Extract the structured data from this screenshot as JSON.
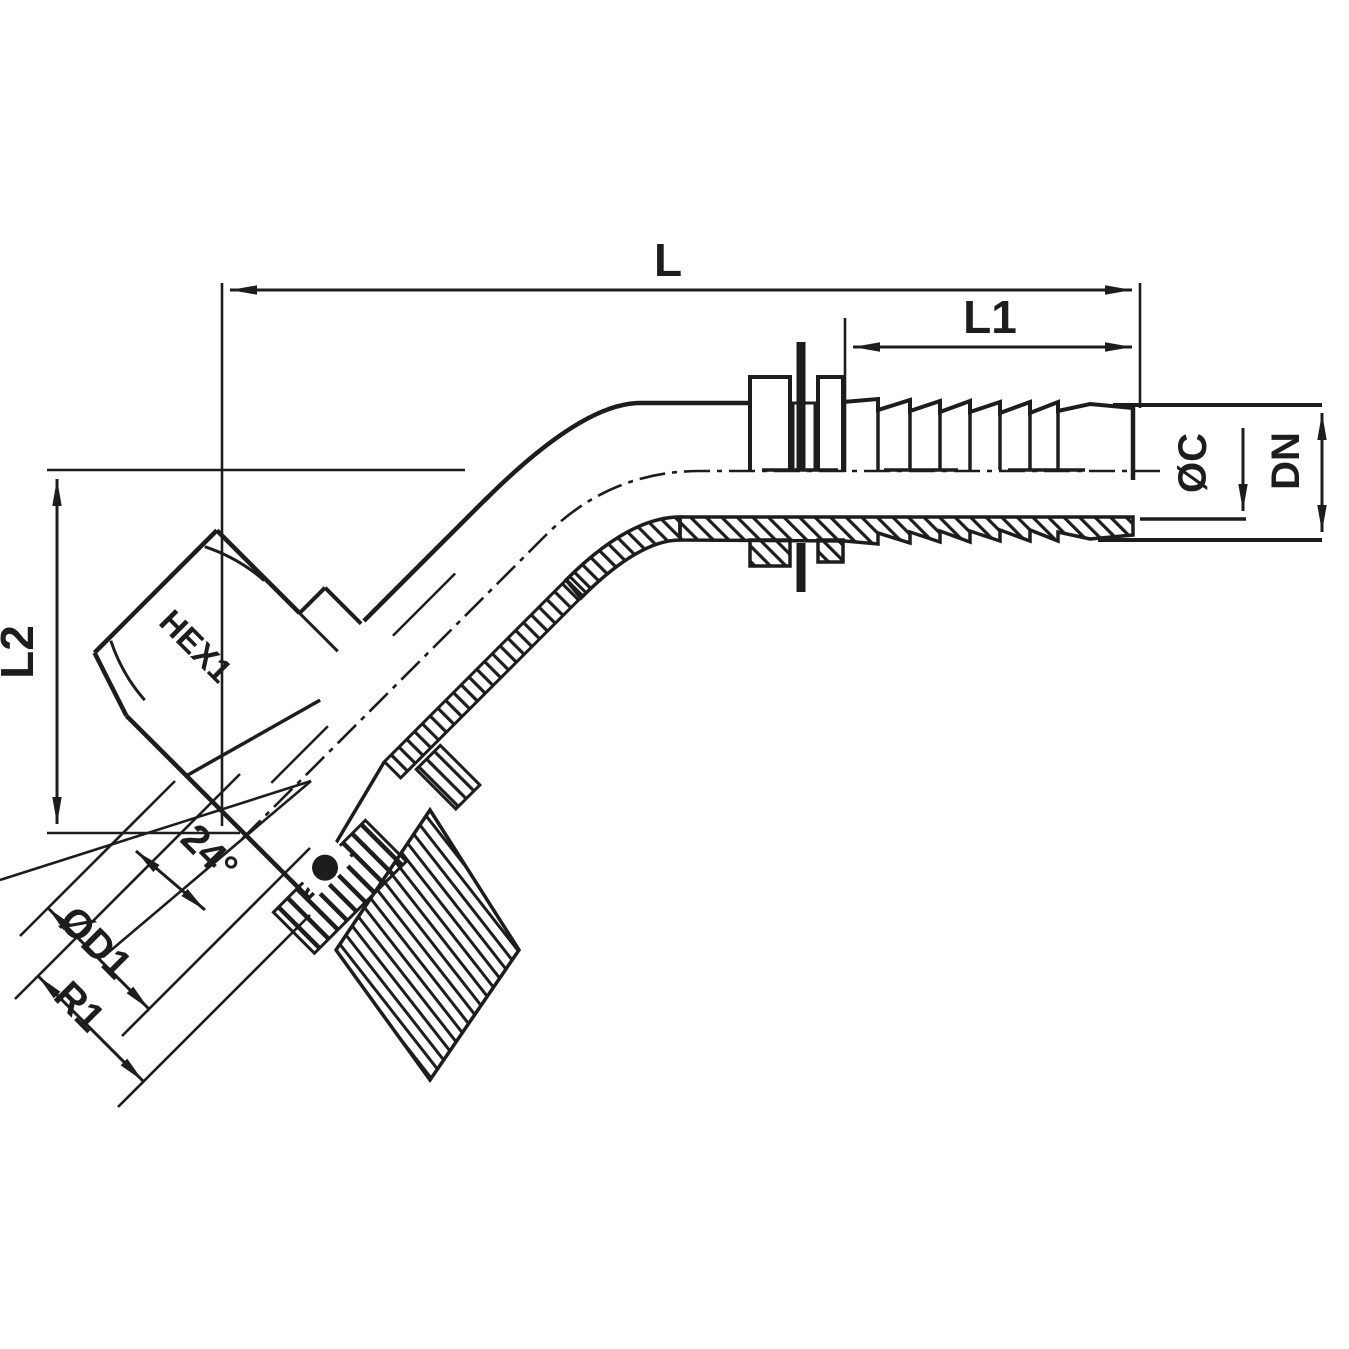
{
  "drawing": {
    "kind": "technical-drawing",
    "subject": "45-degree hose fitting cross-section with dimension callouts",
    "colors": {
      "ink": "#1d1d1d",
      "background": "#ffffff"
    },
    "labels": {
      "overall_length": "L",
      "tail_length": "L1",
      "drop_height": "L2",
      "tail_diameter": "ØC",
      "nominal_bore": "DN",
      "hex_size": "HEX1",
      "cone_angle": "24°",
      "cone_diameter": "ØD1",
      "thread_size": "R1"
    }
  }
}
